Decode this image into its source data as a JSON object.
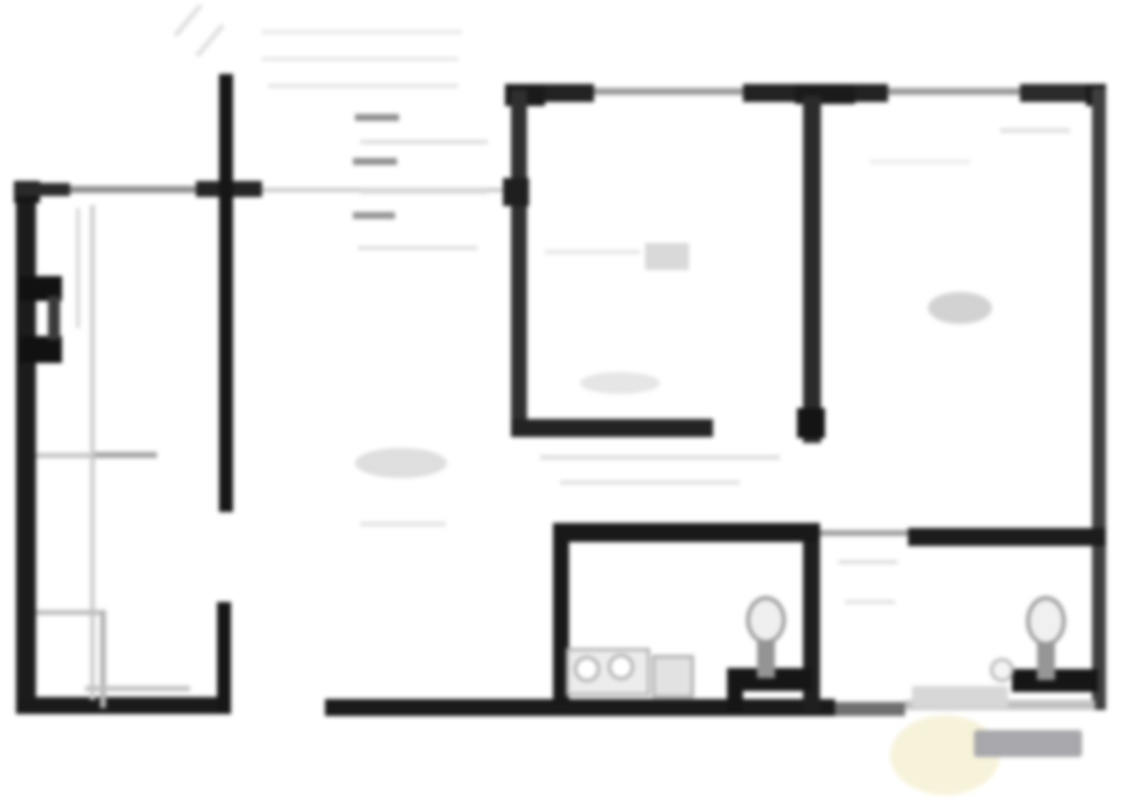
{
  "plan": {
    "title": "blurred architectural floor plan",
    "width": 1127,
    "height": 800,
    "background": "#ffffff",
    "blur_px": 2.2
  },
  "palette": {
    "wall_dark": "#1a1a1a",
    "wall_medium": "#3d3d3d",
    "window_gray": "#9a9a9a",
    "faint_line": "#cfcfcf",
    "ghost_line": "#e4e4e4",
    "fixture_gray": "#a8a8a8",
    "watermark_gray": "#a8a8ac",
    "watermark_yellow": "#f4efcd"
  },
  "elements": [
    {
      "name": "top-wall-segment-1",
      "shape": "rect",
      "x": 515,
      "y": 84,
      "w": 79,
      "h": 18,
      "color": "#222222"
    },
    {
      "name": "top-wall-window-1",
      "shape": "rect",
      "x": 594,
      "y": 88,
      "w": 149,
      "h": 7,
      "color": "#9a9a9a"
    },
    {
      "name": "top-wall-segment-2",
      "shape": "rect",
      "x": 743,
      "y": 84,
      "w": 145,
      "h": 18,
      "color": "#222222"
    },
    {
      "name": "top-wall-window-2",
      "shape": "rect",
      "x": 888,
      "y": 88,
      "w": 132,
      "h": 7,
      "color": "#9a9a9a"
    },
    {
      "name": "top-wall-segment-3",
      "shape": "rect",
      "x": 1020,
      "y": 84,
      "w": 86,
      "h": 18,
      "color": "#2a2a2a"
    },
    {
      "name": "top-left-corner-cap-room",
      "shape": "rect",
      "x": 505,
      "y": 84,
      "w": 40,
      "h": 22,
      "color": "#1a1a1a"
    },
    {
      "name": "top-tee-cap-partition",
      "shape": "rect",
      "x": 795,
      "y": 84,
      "w": 60,
      "h": 20,
      "color": "#1a1a1a"
    },
    {
      "name": "top-right-corner-cap",
      "shape": "rect",
      "x": 1086,
      "y": 84,
      "w": 20,
      "h": 22,
      "color": "#1a1a1a"
    },
    {
      "name": "right-exterior-wall",
      "shape": "rect",
      "x": 1092,
      "y": 88,
      "w": 14,
      "h": 622,
      "color": "#3f3f3f"
    },
    {
      "name": "left-exterior-wall",
      "shape": "rect",
      "x": 16,
      "y": 183,
      "w": 20,
      "h": 531,
      "color": "#1c1c1c"
    },
    {
      "name": "left-top-corner-cap",
      "shape": "rect",
      "x": 14,
      "y": 181,
      "w": 26,
      "h": 22,
      "color": "#161616"
    },
    {
      "name": "left-top-wall-dark",
      "shape": "rect",
      "x": 16,
      "y": 183,
      "w": 54,
      "h": 13,
      "color": "#2a2a2a"
    },
    {
      "name": "left-top-wall-thin",
      "shape": "rect",
      "x": 70,
      "y": 186,
      "w": 130,
      "h": 7,
      "color": "#8f8f8f"
    },
    {
      "name": "left-top-wall-dark-2",
      "shape": "rect",
      "x": 196,
      "y": 181,
      "w": 66,
      "h": 16,
      "color": "#242424"
    },
    {
      "name": "hall-top-faint-line",
      "shape": "rect",
      "x": 262,
      "y": 188,
      "w": 253,
      "h": 4,
      "color": "#c7c7c7"
    },
    {
      "name": "bottom-wall-left",
      "shape": "rect",
      "x": 16,
      "y": 697,
      "w": 202,
      "h": 17,
      "color": "#1a1a1a"
    },
    {
      "name": "bottom-wall-mid",
      "shape": "rect",
      "x": 325,
      "y": 699,
      "w": 510,
      "h": 17,
      "color": "#1a1a1a"
    },
    {
      "name": "bottom-wall-door-strip",
      "shape": "rect",
      "x": 835,
      "y": 702,
      "w": 70,
      "h": 14,
      "color": "#6f6f6f"
    },
    {
      "name": "bottom-wall-right-faint",
      "shape": "rect",
      "x": 905,
      "y": 700,
      "w": 190,
      "h": 10,
      "color": "#c2c2c2"
    },
    {
      "name": "interior-wall-vertical-upper",
      "shape": "rect",
      "x": 219,
      "y": 74,
      "w": 14,
      "h": 438,
      "color": "#161616"
    },
    {
      "name": "interior-wall-vertical-lower",
      "shape": "rect",
      "x": 217,
      "y": 602,
      "w": 14,
      "h": 112,
      "color": "#161616"
    },
    {
      "name": "center-room-left-wall",
      "shape": "rect",
      "x": 511,
      "y": 90,
      "w": 16,
      "h": 347,
      "color": "#2f2f2f"
    },
    {
      "name": "center-room-left-wall-hinge",
      "shape": "rect",
      "x": 503,
      "y": 178,
      "w": 26,
      "h": 28,
      "color": "#1f1f1f"
    },
    {
      "name": "center-room-bottom-wall",
      "shape": "rect",
      "x": 511,
      "y": 419,
      "w": 202,
      "h": 18,
      "color": "#232323"
    },
    {
      "name": "partition-wall-upper",
      "shape": "rect",
      "x": 803,
      "y": 96,
      "w": 18,
      "h": 347,
      "color": "#2b2b2b"
    },
    {
      "name": "partition-wall-upper-end-cap",
      "shape": "rect",
      "x": 797,
      "y": 408,
      "w": 28,
      "h": 30,
      "color": "#141414"
    },
    {
      "name": "partition-wall-lower",
      "shape": "rect",
      "x": 803,
      "y": 528,
      "w": 17,
      "h": 184,
      "color": "#1f1f1f"
    },
    {
      "name": "bath1-top-wall",
      "shape": "rect",
      "x": 553,
      "y": 523,
      "w": 267,
      "h": 19,
      "color": "#191919"
    },
    {
      "name": "bath1-left-wall",
      "shape": "rect",
      "x": 553,
      "y": 523,
      "w": 16,
      "h": 182,
      "color": "#191919"
    },
    {
      "name": "bath-door-threshold-line",
      "shape": "rect",
      "x": 820,
      "y": 530,
      "w": 88,
      "h": 6,
      "color": "#9f9f9f"
    },
    {
      "name": "bath2-top-wall",
      "shape": "rect",
      "x": 908,
      "y": 528,
      "w": 198,
      "h": 18,
      "color": "#1c1c1c"
    },
    {
      "name": "bath1-niche-wall-horizontal",
      "shape": "rect",
      "x": 727,
      "y": 668,
      "w": 85,
      "h": 23,
      "color": "#161616"
    },
    {
      "name": "bath1-niche-wall-vertical",
      "shape": "rect",
      "x": 727,
      "y": 668,
      "w": 16,
      "h": 44,
      "color": "#161616"
    },
    {
      "name": "bath2-niche-wall-horizontal",
      "shape": "rect",
      "x": 1012,
      "y": 669,
      "w": 86,
      "h": 23,
      "color": "#161616"
    },
    {
      "name": "left-wall-feature-top",
      "shape": "rect",
      "x": 20,
      "y": 276,
      "w": 42,
      "h": 25,
      "color": "#111111"
    },
    {
      "name": "left-wall-feature-bottom",
      "shape": "rect",
      "x": 20,
      "y": 336,
      "w": 42,
      "h": 27,
      "color": "#111111"
    },
    {
      "name": "left-wall-feature-edge",
      "shape": "rect",
      "x": 48,
      "y": 296,
      "w": 12,
      "h": 44,
      "color": "#3a3a3a"
    },
    {
      "name": "wardrobe-line-vertical",
      "shape": "rect",
      "x": 90,
      "y": 205,
      "w": 5,
      "h": 495,
      "color": "#cfcfcf"
    },
    {
      "name": "wardrobe-line-vertical-2",
      "shape": "rect",
      "x": 76,
      "y": 208,
      "w": 4,
      "h": 120,
      "color": "#d8d8d8"
    },
    {
      "name": "left-room-shelf-line",
      "shape": "rect",
      "x": 36,
      "y": 453,
      "w": 120,
      "h": 5,
      "color": "#c4c4c4"
    },
    {
      "name": "left-room-shelf-dash",
      "shape": "rect",
      "x": 95,
      "y": 452,
      "w": 62,
      "h": 6,
      "color": "#a3a3a3"
    },
    {
      "name": "closet-line-horizontal-1",
      "shape": "rect",
      "x": 36,
      "y": 610,
      "w": 70,
      "h": 5,
      "color": "#bdbdbd"
    },
    {
      "name": "closet-line-vertical",
      "shape": "rect",
      "x": 100,
      "y": 610,
      "w": 6,
      "h": 98,
      "color": "#b5b5b5"
    },
    {
      "name": "closet-line-horizontal-2",
      "shape": "rect",
      "x": 85,
      "y": 686,
      "w": 105,
      "h": 5,
      "color": "#c0c0c0"
    },
    {
      "name": "hall-dash-1",
      "shape": "rect",
      "x": 355,
      "y": 114,
      "w": 44,
      "h": 7,
      "color": "#8e8e8e"
    },
    {
      "name": "hall-dash-2",
      "shape": "rect",
      "x": 353,
      "y": 158,
      "w": 44,
      "h": 7,
      "color": "#8e8e8e"
    },
    {
      "name": "hall-dash-3",
      "shape": "rect",
      "x": 353,
      "y": 212,
      "w": 42,
      "h": 7,
      "color": "#939393"
    },
    {
      "name": "hall-faint-line-1",
      "shape": "rect",
      "x": 360,
      "y": 140,
      "w": 128,
      "h": 4,
      "color": "#dcdcdc"
    },
    {
      "name": "hall-faint-line-2",
      "shape": "rect",
      "x": 360,
      "y": 190,
      "w": 128,
      "h": 4,
      "color": "#dcdcdc"
    },
    {
      "name": "hall-faint-line-3",
      "shape": "rect",
      "x": 358,
      "y": 246,
      "w": 120,
      "h": 4,
      "color": "#dfdfdf"
    },
    {
      "name": "hall-ghost-line-1",
      "shape": "rect",
      "x": 262,
      "y": 30,
      "w": 200,
      "h": 4,
      "color": "#e6e6e6"
    },
    {
      "name": "hall-ghost-line-2",
      "shape": "rect",
      "x": 262,
      "y": 57,
      "w": 196,
      "h": 4,
      "color": "#e6e6e6"
    },
    {
      "name": "hall-ghost-line-3",
      "shape": "rect",
      "x": 268,
      "y": 84,
      "w": 190,
      "h": 4,
      "color": "#e3e3e3"
    },
    {
      "name": "stair-ghost-diagonal-1",
      "shape": "rect",
      "x": 168,
      "y": 18,
      "w": 40,
      "h": 5,
      "color": "#e0e0e0",
      "rot": -50
    },
    {
      "name": "stair-ghost-diagonal-2",
      "shape": "rect",
      "x": 190,
      "y": 38,
      "w": 40,
      "h": 5,
      "color": "#e0e0e0",
      "rot": -50
    },
    {
      "name": "hall-smudge",
      "shape": "ellipse",
      "x": 355,
      "y": 448,
      "w": 92,
      "h": 30,
      "color": "#dedede"
    },
    {
      "name": "hall-smudge-line",
      "shape": "rect",
      "x": 360,
      "y": 522,
      "w": 86,
      "h": 4,
      "color": "#e0e0e0"
    },
    {
      "name": "center-room-smudge-rect",
      "shape": "rect",
      "x": 645,
      "y": 243,
      "w": 44,
      "h": 27,
      "color": "#d9d9d9"
    },
    {
      "name": "center-room-smudge-line",
      "shape": "rect",
      "x": 545,
      "y": 250,
      "w": 95,
      "h": 4,
      "color": "#e4e4e4"
    },
    {
      "name": "center-room-smudge-oval",
      "shape": "ellipse",
      "x": 580,
      "y": 372,
      "w": 80,
      "h": 22,
      "color": "#e6e6e6"
    },
    {
      "name": "dimension-scribble-1",
      "shape": "rect",
      "x": 540,
      "y": 455,
      "w": 240,
      "h": 5,
      "color": "#e0e0e0"
    },
    {
      "name": "dimension-scribble-2",
      "shape": "rect",
      "x": 560,
      "y": 480,
      "w": 180,
      "h": 5,
      "color": "#e5e5e5"
    },
    {
      "name": "right-room-label-smudge",
      "shape": "ellipse",
      "x": 928,
      "y": 292,
      "w": 64,
      "h": 32,
      "color": "#d2d2d2"
    },
    {
      "name": "right-room-faint-mark-1",
      "shape": "rect",
      "x": 1000,
      "y": 128,
      "w": 70,
      "h": 5,
      "color": "#e2e2e2"
    },
    {
      "name": "right-room-faint-mark-2",
      "shape": "rect",
      "x": 870,
      "y": 160,
      "w": 100,
      "h": 4,
      "color": "#eaeaea"
    },
    {
      "name": "bath-hall-faint-mark-1",
      "shape": "rect",
      "x": 838,
      "y": 560,
      "w": 60,
      "h": 4,
      "color": "#dedede"
    },
    {
      "name": "bath-hall-faint-mark-2",
      "shape": "rect",
      "x": 845,
      "y": 600,
      "w": 50,
      "h": 4,
      "color": "#e2e2e2"
    },
    {
      "name": "toilet1-bowl",
      "shape": "ellipse",
      "x": 746,
      "y": 596,
      "w": 40,
      "h": 48,
      "color": "#efefef",
      "border": "4px solid #9b9b9b"
    },
    {
      "name": "toilet1-tank",
      "shape": "rect",
      "x": 757,
      "y": 640,
      "w": 18,
      "h": 38,
      "color": "#949494"
    },
    {
      "name": "toilet2-bowl",
      "shape": "ellipse",
      "x": 1026,
      "y": 596,
      "w": 40,
      "h": 50,
      "color": "#f0f0f0",
      "border": "4px solid #9b9b9b"
    },
    {
      "name": "toilet2-tank",
      "shape": "rect",
      "x": 1037,
      "y": 642,
      "w": 18,
      "h": 38,
      "color": "#969696"
    },
    {
      "name": "sink-counter",
      "shape": "rect",
      "x": 566,
      "y": 648,
      "w": 84,
      "h": 48,
      "color": "#ececec",
      "border": "3px solid #b0b0b0"
    },
    {
      "name": "sink-bowl-1",
      "shape": "ellipse",
      "x": 574,
      "y": 656,
      "w": 26,
      "h": 26,
      "color": "#ffffff",
      "border": "3px solid #a8a8a8"
    },
    {
      "name": "sink-bowl-2",
      "shape": "ellipse",
      "x": 608,
      "y": 654,
      "w": 26,
      "h": 26,
      "color": "#ffffff",
      "border": "3px solid #a8a8a8"
    },
    {
      "name": "sink-cabinet-box",
      "shape": "rect",
      "x": 652,
      "y": 655,
      "w": 42,
      "h": 43,
      "color": "#e2e2e2",
      "border": "3px solid #adadad"
    },
    {
      "name": "bath2-counter",
      "shape": "rect",
      "x": 912,
      "y": 686,
      "w": 96,
      "h": 22,
      "color": "#d7d7d7"
    },
    {
      "name": "bath2-basin",
      "shape": "ellipse",
      "x": 990,
      "y": 658,
      "w": 24,
      "h": 24,
      "color": "#f4f4f4",
      "border": "3px solid #b3b3b3"
    },
    {
      "name": "watermark-yellow-blob",
      "shape": "ellipse",
      "x": 890,
      "y": 715,
      "w": 110,
      "h": 80,
      "color": "#f4efcd",
      "opacity": 0.75
    },
    {
      "name": "watermark-gray-bar",
      "shape": "rect",
      "x": 974,
      "y": 730,
      "w": 108,
      "h": 27,
      "color": "#a8a8ac",
      "radius": 3
    }
  ]
}
